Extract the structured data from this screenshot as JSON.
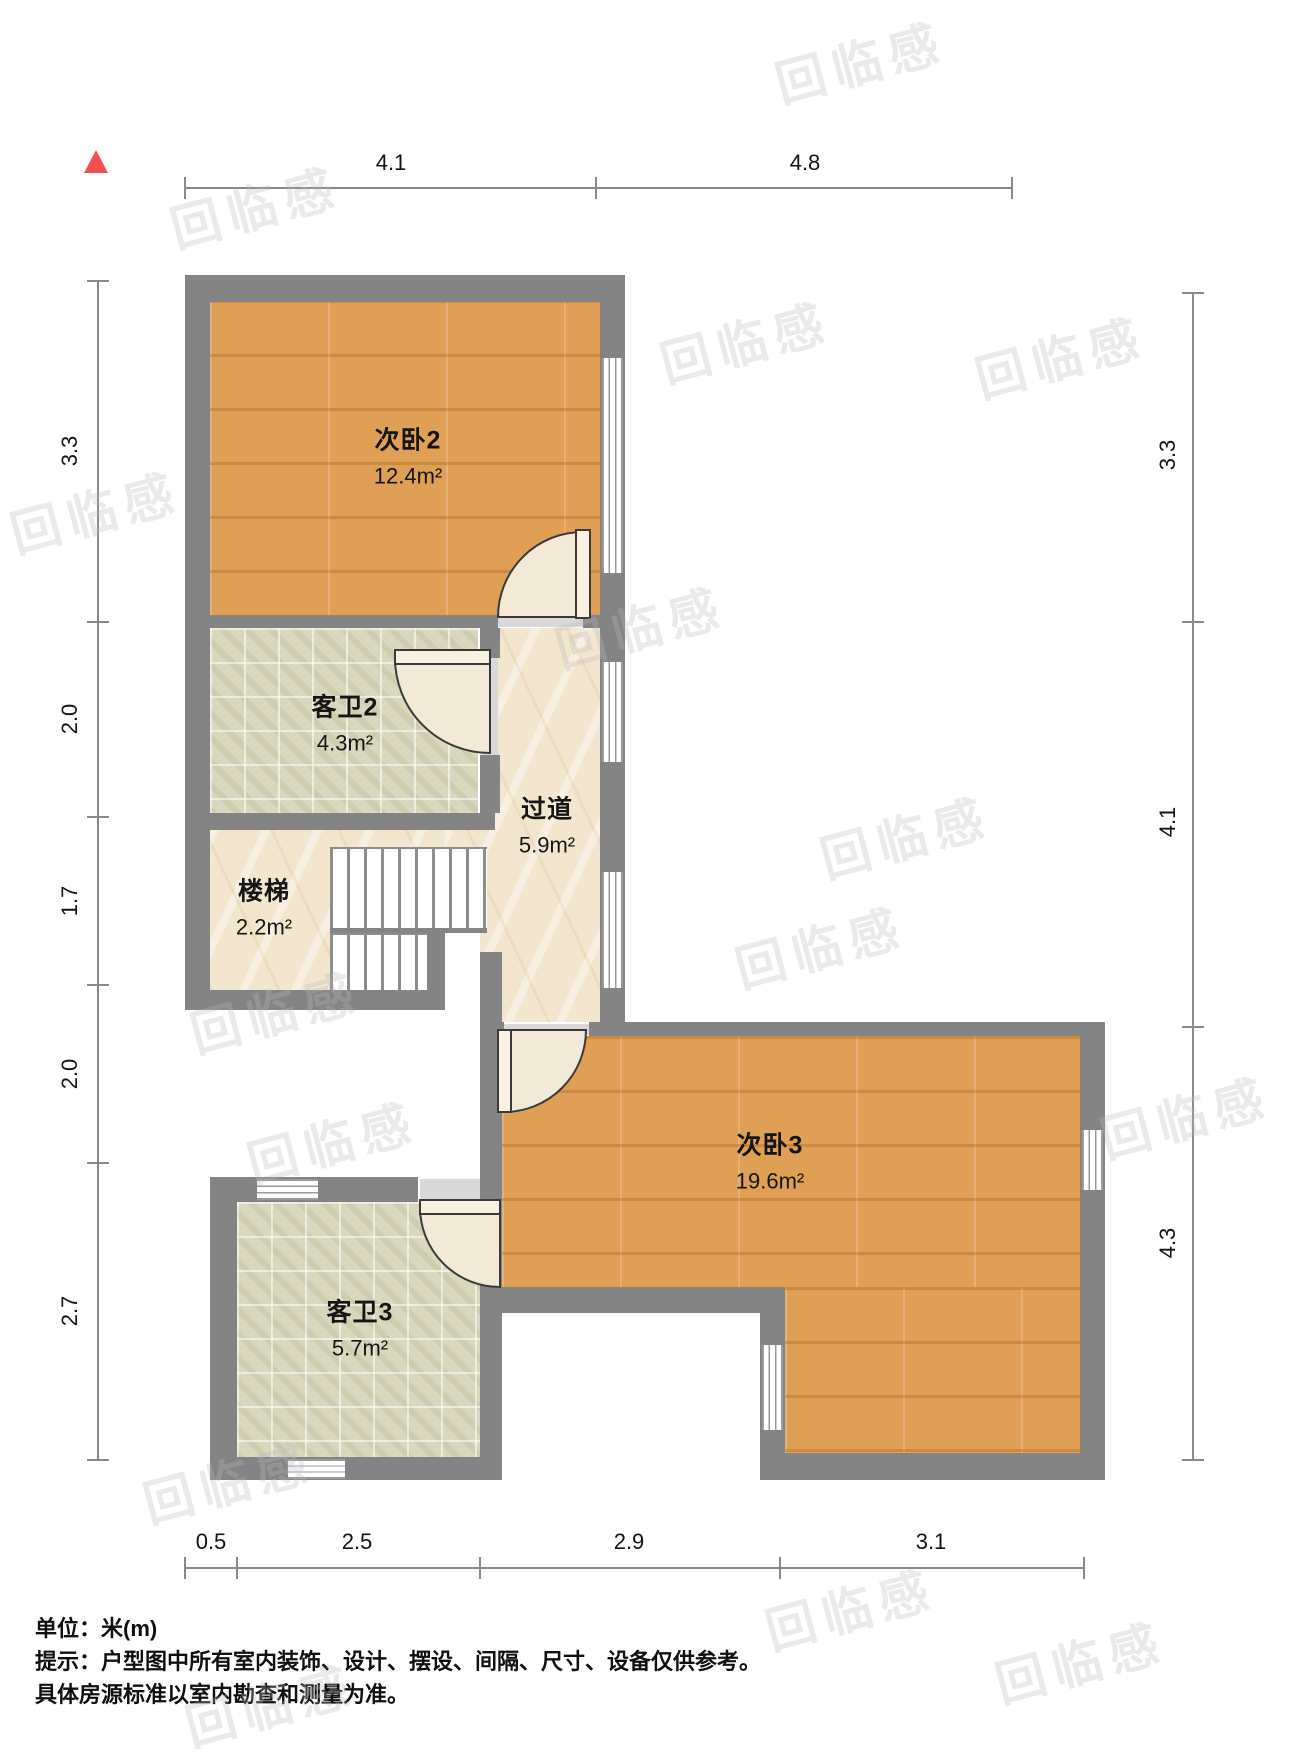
{
  "rooms": [
    {
      "name": "次卧2",
      "area": "12.4m²"
    },
    {
      "name": "客卫2",
      "area": "4.3m²"
    },
    {
      "name": "过道",
      "area": "5.9m²"
    },
    {
      "name": "楼梯",
      "area": "2.2m²"
    },
    {
      "name": "次卧3",
      "area": "19.6m²"
    },
    {
      "name": "客卫3",
      "area": "5.7m²"
    }
  ],
  "dimensions": {
    "top": [
      "4.1",
      "4.8"
    ],
    "left": [
      "3.3",
      "2.0",
      "1.7",
      "2.0",
      "2.7"
    ],
    "right": [
      "3.3",
      "4.1",
      "4.3"
    ],
    "bottom": [
      "0.5",
      "2.5",
      "2.9",
      "3.1"
    ]
  },
  "notes": {
    "unit": "单位：米(m)",
    "tip": "提示：户型图中所有室内装饰、设计、摆设、间隔、尺寸、设备仅供参考。",
    "tip2": "具体房源标准以室内勘查和测量为准。"
  },
  "watermark_text": "回临感",
  "colors": {
    "wall": "#848484",
    "wood_floor": "#dfa055",
    "tile_floor": "#d9d7bd",
    "marble_floor": "#f2e6cf",
    "north_arrow": "#f2504f",
    "dimension_line": "#8a8a8a"
  }
}
